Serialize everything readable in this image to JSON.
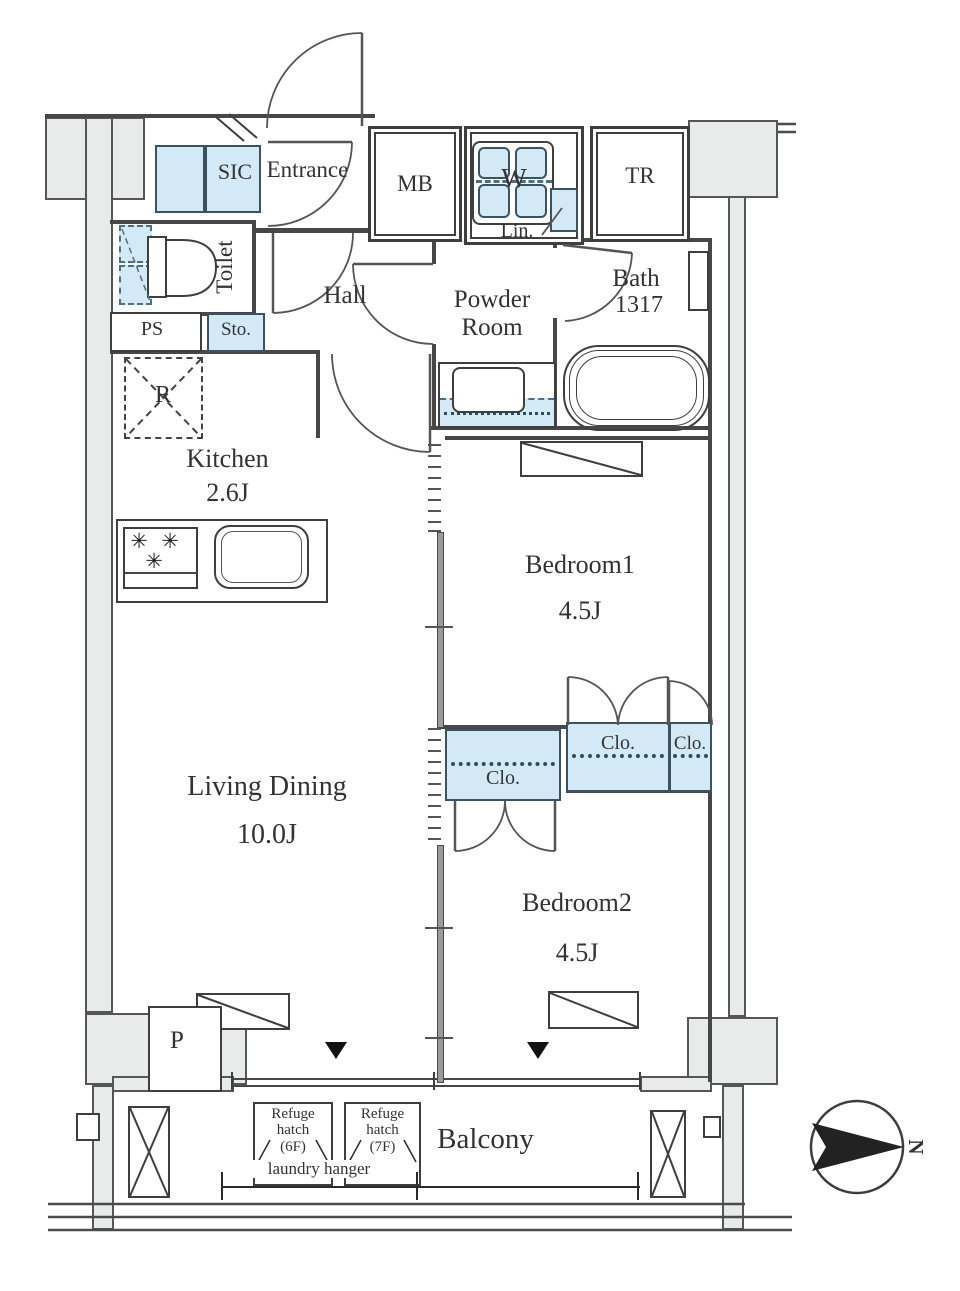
{
  "colors": {
    "fixture_blue": "#d3eaf6",
    "wall_gray": "#e9ebeb",
    "line_dark": "#474747",
    "text": "#333333"
  },
  "icons": {
    "burner": "✳",
    "window_marker": "▼"
  },
  "rooms": {
    "sic": {
      "label": "SIC"
    },
    "entrance": {
      "label": "Entrance"
    },
    "mb": {
      "label": "MB"
    },
    "washer": {
      "label": "W"
    },
    "linen": {
      "label": "Lin."
    },
    "trunk": {
      "label": "TR"
    },
    "toilet": {
      "label": "Toilet"
    },
    "pipe_space": {
      "label": "PS"
    },
    "storage": {
      "label": "Sto."
    },
    "hall": {
      "label": "Hall"
    },
    "powder_room": {
      "line1": "Powder",
      "line2": "Room"
    },
    "bath": {
      "line1": "Bath",
      "line2": "1317"
    },
    "kitchen": {
      "label": "Kitchen",
      "size": "2.6J"
    },
    "refrigerator": {
      "label": "R"
    },
    "bedroom1": {
      "label": "Bedroom1",
      "size": "4.5J"
    },
    "living_dining": {
      "label": "Living Dining",
      "size": "10.0J"
    },
    "bedroom2": {
      "label": "Bedroom2",
      "size": "4.5J"
    },
    "closet_bedroom2": {
      "label": "Clo."
    },
    "closet_bedroom1_large": {
      "label": "Clo."
    },
    "closet_bedroom1_small": {
      "label": "Clo."
    },
    "pillar": {
      "label": "P"
    },
    "balcony": {
      "label": "Balcony"
    },
    "refuge_hatch_6f": {
      "line1": "Refuge",
      "line2": "hatch",
      "line3": "(6F)"
    },
    "refuge_hatch_7f": {
      "line1": "Refuge",
      "line2": "hatch",
      "line3": "(7F)"
    },
    "laundry_hanger": {
      "label": "laundry hanger"
    },
    "compass": {
      "label": "N"
    }
  }
}
